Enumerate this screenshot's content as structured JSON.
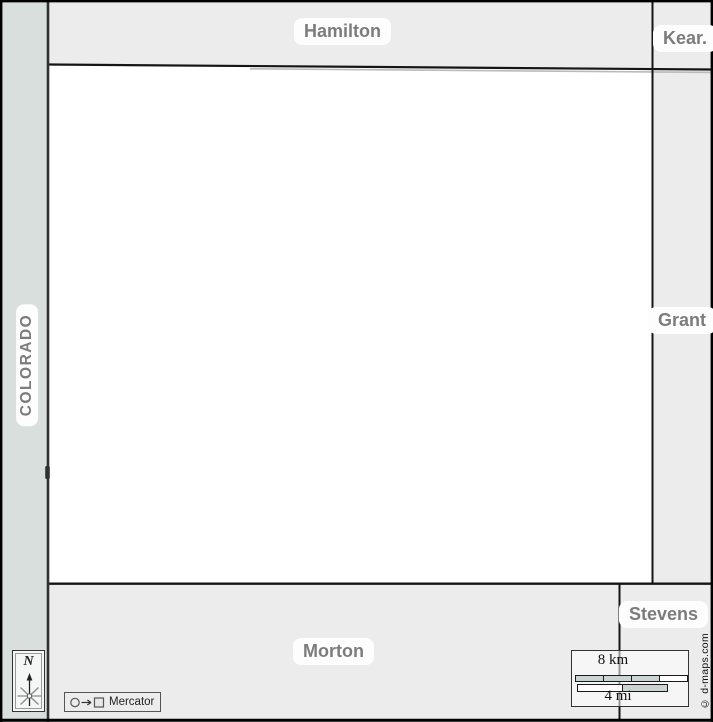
{
  "neighbors": {
    "north": "Hamilton",
    "northeast": "Kear.",
    "east": "Grant",
    "southeast": "Stevens",
    "south": "Morton",
    "west_state": "COLORADO"
  },
  "compass": {
    "north_label": "N"
  },
  "projection": {
    "label": "Mercator"
  },
  "scalebar": {
    "km_label": "8 km",
    "mi_label": "4 mi"
  },
  "credit": {
    "text": "© d-maps.com"
  },
  "colors": {
    "surround_band": "#ececec",
    "colorado_band": "#d9dfdd",
    "county_fill": "#ffffff",
    "border_line": "#151515",
    "state_line": "#2e3232",
    "label_text": "#7c7c7c",
    "label_pill_bg": "#fdfdfd",
    "scale_gray": "#ccd3d3"
  }
}
